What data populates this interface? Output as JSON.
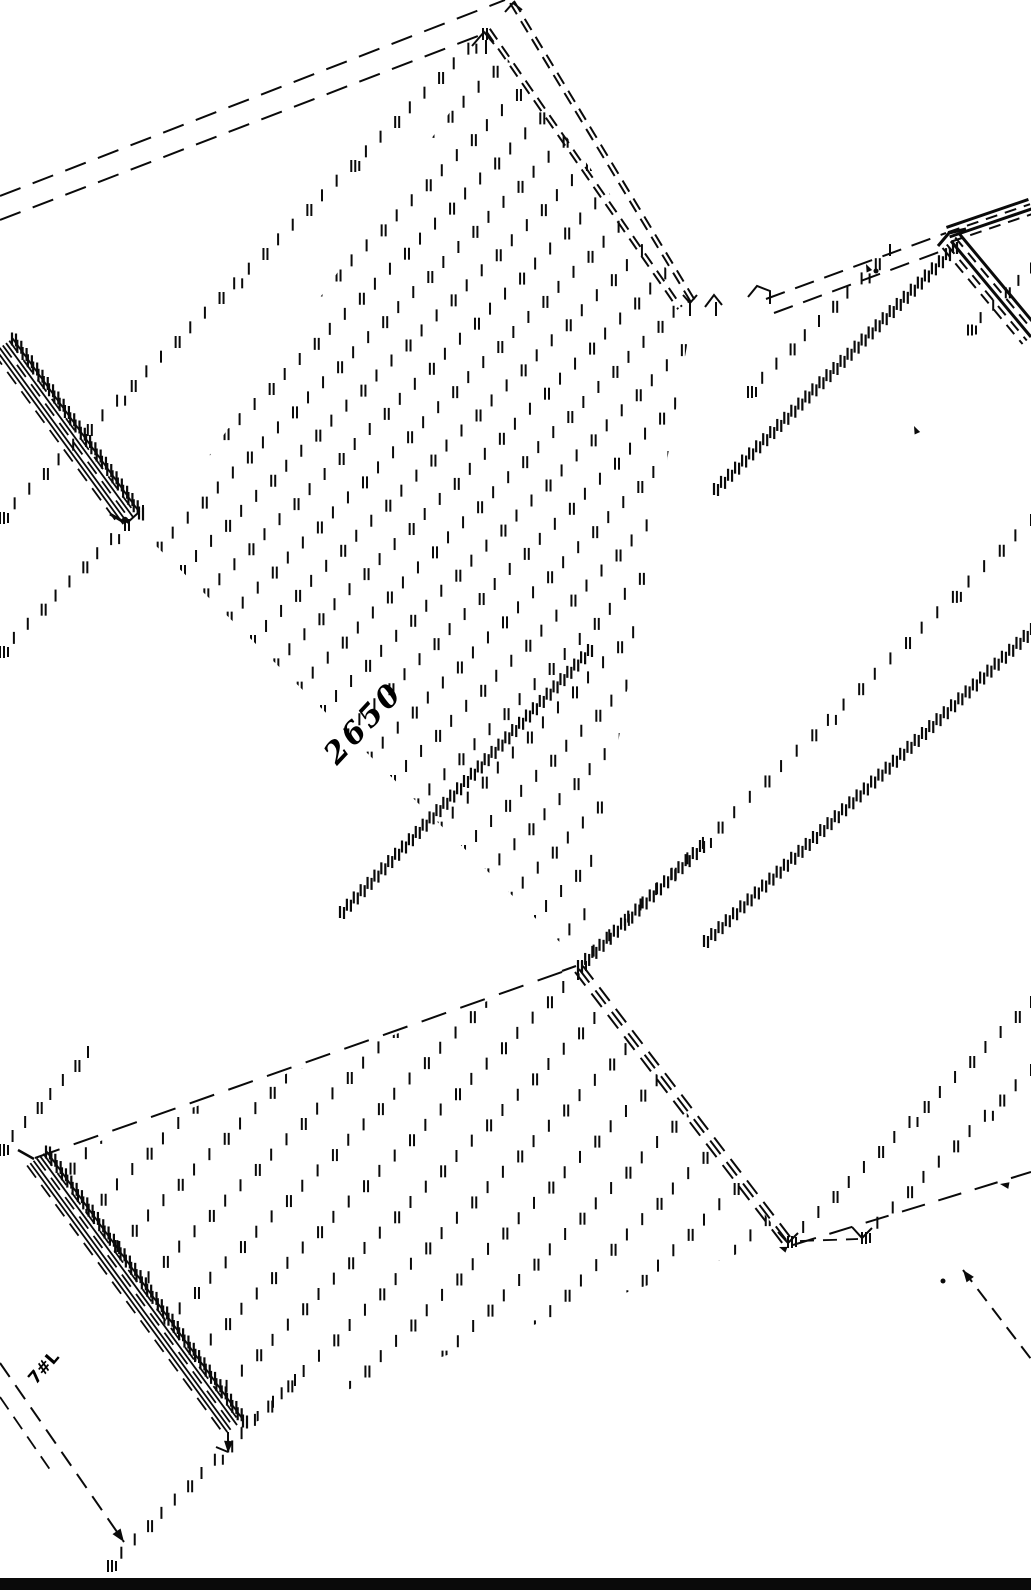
{
  "colors": {
    "ink": "#0a0a0a",
    "paper": "#ffffff"
  },
  "labels": {
    "center": {
      "text": "2650"
    },
    "bottom_left": {
      "text": "7#L"
    }
  },
  "drawing": {
    "canvas": {
      "w": 1031,
      "h": 1590
    },
    "dashed_lines": [
      {
        "id": "eave-back-1",
        "x1": 0,
        "y1": 196,
        "x2": 505,
        "y2": 0,
        "dash": [
          22,
          13
        ],
        "w": 2
      },
      {
        "id": "eave-back-2",
        "x1": 0,
        "y1": 220,
        "x2": 478,
        "y2": 36,
        "dash": [
          22,
          13
        ],
        "w": 2
      },
      {
        "id": "eave-right-1",
        "x1": 766,
        "y1": 299,
        "x2": 946,
        "y2": 233,
        "dash": [
          20,
          11
        ],
        "w": 2
      },
      {
        "id": "eave-right-2",
        "x1": 774,
        "y1": 313,
        "x2": 950,
        "y2": 248,
        "dash": [
          20,
          11
        ],
        "w": 2
      },
      {
        "id": "valley-long",
        "x1": 35,
        "y1": 1158,
        "x2": 576,
        "y2": 967,
        "dash": [
          26,
          15
        ],
        "w": 2
      },
      {
        "id": "slope-line-bl",
        "x1": 0,
        "y1": 1363,
        "x2": 124,
        "y2": 1542,
        "dash": [
          17,
          10
        ],
        "w": 2
      },
      {
        "id": "slope-line-bl-2",
        "x1": 0,
        "y1": 1397,
        "x2": 53,
        "y2": 1474,
        "dash": [
          15,
          9
        ],
        "w": 1.8
      },
      {
        "id": "bottom-right-long",
        "x1": 793,
        "y1": 1245,
        "x2": 1031,
        "y2": 1172,
        "dash": [
          24,
          14
        ],
        "w": 2
      },
      {
        "id": "bottom-right-short",
        "x1": 800,
        "y1": 1241,
        "x2": 858,
        "y2": 1239,
        "dash": [
          14,
          9
        ],
        "w": 1.8
      },
      {
        "id": "slope-line-br",
        "x1": 963,
        "y1": 1270,
        "x2": 1031,
        "y2": 1359,
        "dash": [
          15,
          9
        ],
        "w": 2
      },
      {
        "id": "ridge-band-a",
        "x1": 512,
        "y1": 2,
        "x2": 694,
        "y2": 303,
        "dash": [
          13,
          8
        ],
        "w": 2,
        "dbl": true
      },
      {
        "id": "ridge-band-b",
        "x1": 488,
        "y1": 30,
        "x2": 680,
        "y2": 308,
        "dash": [
          13,
          8
        ],
        "w": 2,
        "dbl": true
      }
    ],
    "ribbons": [
      {
        "id": "parapet-left",
        "x1": 2,
        "y1": 346,
        "x2": 129,
        "y2": 520,
        "offsets": [
          -13,
          -9,
          -5,
          -1,
          3,
          7,
          11
        ],
        "styles": [
          "s",
          "d",
          "s",
          "d",
          "s",
          "s",
          "d"
        ],
        "w": 1.8,
        "dash": [
          15,
          9
        ]
      },
      {
        "id": "parapet-lower",
        "x1": 36,
        "y1": 1159,
        "x2": 233,
        "y2": 1428,
        "offsets": [
          -13,
          -9,
          -5,
          -1,
          3,
          7,
          11
        ],
        "styles": [
          "s",
          "d",
          "s",
          "d",
          "s",
          "s",
          "d"
        ],
        "w": 1.8,
        "dash": [
          15,
          9
        ]
      },
      {
        "id": "ridge-center",
        "x1": 579,
        "y1": 969,
        "x2": 787,
        "y2": 1241,
        "offsets": [
          -5,
          0,
          5
        ],
        "styles": [
          "d",
          "d",
          "d"
        ],
        "w": 2,
        "dash": [
          17,
          10
        ]
      },
      {
        "id": "eave-tr-up",
        "x1": 949,
        "y1": 235,
        "x2": 1031,
        "y2": 207,
        "offsets": [
          -8,
          -3,
          2,
          7
        ],
        "styles": [
          "S",
          "d",
          "S",
          "d"
        ],
        "w": 2,
        "dash": [
          12,
          8
        ]
      },
      {
        "id": "eave-tr-down",
        "x1": 951,
        "y1": 241,
        "x2": 1031,
        "y2": 337,
        "offsets": [
          -11,
          -5.5,
          0,
          5.5,
          11
        ],
        "styles": [
          "S",
          "d",
          "S",
          "d",
          "d"
        ],
        "w": 2,
        "dash": [
          12,
          8
        ]
      }
    ],
    "tick_lines": [
      {
        "id": "hatch-left-long",
        "x1": 0,
        "y1": 518,
        "x2": 483,
        "y2": 34,
        "gap": 21,
        "len": 12,
        "dense": false
      },
      {
        "id": "hatch-below-corner",
        "x1": 0,
        "y1": 652,
        "x2": 125,
        "y2": 525,
        "gap": 20,
        "len": 12,
        "dense": false
      },
      {
        "id": "hatch-left-low",
        "x1": 0,
        "y1": 1150,
        "x2": 88,
        "y2": 1052,
        "gap": 20,
        "len": 12,
        "dense": false
      },
      {
        "id": "edge-ticks-parapet",
        "x1": 12,
        "y1": 339,
        "x2": 139,
        "y2": 513,
        "gap": 9,
        "len": 13,
        "dense": true
      },
      {
        "id": "edge-ticks-parapet2",
        "x1": 46,
        "y1": 1152,
        "x2": 243,
        "y2": 1421,
        "gap": 9,
        "len": 13,
        "dense": true
      },
      {
        "id": "hatch-bl-bottom",
        "x1": 108,
        "y1": 1566,
        "x2": 295,
        "y2": 1380,
        "gap": 19,
        "len": 12,
        "dense": false
      },
      {
        "id": "hatch-center-right",
        "x1": 578,
        "y1": 966,
        "x2": 1031,
        "y2": 520,
        "gap": 22,
        "len": 12,
        "dense": false
      },
      {
        "id": "hatch-cr-dense",
        "x1": 578,
        "y1": 966,
        "x2": 700,
        "y2": 846,
        "gap": 10,
        "len": 12,
        "dense": true
      },
      {
        "id": "zip-right-1",
        "x1": 714,
        "y1": 489,
        "x2": 953,
        "y2": 247,
        "gap": 10,
        "len": 12,
        "dense": true
      },
      {
        "id": "zip-right-2",
        "x1": 704,
        "y1": 941,
        "x2": 1031,
        "y2": 629,
        "gap": 10,
        "len": 12,
        "dense": true
      },
      {
        "id": "zip-center",
        "x1": 340,
        "y1": 912,
        "x2": 588,
        "y2": 650,
        "gap": 10,
        "len": 12,
        "dense": true
      },
      {
        "id": "hatch-right-upper",
        "x1": 748,
        "y1": 392,
        "x2": 890,
        "y2": 250,
        "gap": 21,
        "len": 12,
        "dense": false
      },
      {
        "id": "hatch-tr-small",
        "x1": 968,
        "y1": 330,
        "x2": 1031,
        "y2": 268,
        "gap": 18,
        "len": 11,
        "dense": false
      },
      {
        "id": "hatch-br-1",
        "x1": 788,
        "y1": 1242,
        "x2": 1031,
        "y2": 1002,
        "gap": 21,
        "len": 12,
        "dense": false
      },
      {
        "id": "hatch-br-2",
        "x1": 862,
        "y1": 1238,
        "x2": 1031,
        "y2": 1070,
        "gap": 21,
        "len": 12,
        "dense": false
      }
    ],
    "hatch_fields": [
      {
        "id": "roof-face-main",
        "poly": [
          [
            150,
            540
          ],
          [
            497,
            45
          ],
          [
            694,
            305
          ],
          [
            580,
            962
          ]
        ],
        "spacing": 33,
        "gap": 21,
        "len": 12
      },
      {
        "id": "roof-face-lower",
        "poly": [
          [
            48,
            1160
          ],
          [
            576,
            969
          ],
          [
            783,
            1238
          ],
          [
            238,
            1428
          ]
        ],
        "spacing": 44,
        "gap": 22,
        "len": 12
      }
    ],
    "corner_marks": [
      {
        "pts": [
          [
            472,
            46
          ],
          [
            484,
            32
          ],
          [
            494,
            44
          ]
        ],
        "w": 2
      },
      {
        "pts": [
          [
            486,
            40
          ],
          [
            486,
            54
          ]
        ],
        "w": 2
      },
      {
        "pts": [
          [
            505,
            12
          ],
          [
            513,
            3
          ],
          [
            522,
            10
          ]
        ],
        "w": 2
      },
      {
        "pts": [
          [
            683,
            295
          ],
          [
            690,
            303
          ],
          [
            697,
            295
          ]
        ],
        "w": 2
      },
      {
        "pts": [
          [
            690,
            303
          ],
          [
            690,
            316
          ]
        ],
        "w": 2
      },
      {
        "pts": [
          [
            705,
            307
          ],
          [
            714,
            295
          ],
          [
            722,
            305
          ]
        ],
        "w": 2
      },
      {
        "pts": [
          [
            716,
            302
          ],
          [
            716,
            316
          ]
        ],
        "w": 2
      },
      {
        "pts": [
          [
            748,
            297
          ],
          [
            757,
            286
          ],
          [
            770,
            291
          ],
          [
            770,
            304
          ]
        ],
        "w": 2
      },
      {
        "pts": [
          [
            938,
            246
          ],
          [
            949,
            233
          ],
          [
            966,
            229
          ]
        ],
        "w": 3
      },
      {
        "pts": [
          [
            562,
            971
          ],
          [
            576,
            966
          ]
        ],
        "w": 2
      },
      {
        "pts": [
          [
            578,
            962
          ],
          [
            578,
            980
          ]
        ],
        "w": 2
      },
      {
        "pts": [
          [
            778,
            1232
          ],
          [
            788,
            1243
          ],
          [
            798,
            1233
          ]
        ],
        "w": 2
      },
      {
        "pts": [
          [
            852,
            1227
          ],
          [
            862,
            1238
          ],
          [
            872,
            1228
          ]
        ],
        "w": 2
      },
      {
        "pts": [
          [
            18,
            1150
          ],
          [
            34,
            1159
          ]
        ],
        "w": 2.5
      },
      {
        "pts": [
          [
            110,
            514
          ],
          [
            122,
            521
          ]
        ],
        "w": 3
      },
      {
        "pts": [
          [
            127,
            523
          ],
          [
            138,
            513
          ]
        ],
        "w": 2
      },
      {
        "pts": [
          [
            143,
            505
          ],
          [
            143,
            518
          ]
        ],
        "w": 2
      },
      {
        "pts": [
          [
            228,
            1432
          ],
          [
            228,
            1450
          ]
        ],
        "w": 2
      },
      {
        "pts": [
          [
            216,
            1447
          ],
          [
            228,
            1452
          ]
        ],
        "w": 2
      }
    ],
    "arrows": [
      {
        "x": 124,
        "y": 1542,
        "a": 55,
        "s": 13
      },
      {
        "x": 228,
        "y": 1453,
        "a": 93,
        "s": 12
      },
      {
        "x": 963,
        "y": 1270,
        "a": 233,
        "s": 12
      },
      {
        "x": 1000,
        "y": 1184,
        "a": 190,
        "s": 9
      },
      {
        "x": 866,
        "y": 264,
        "a": 245,
        "s": 8
      },
      {
        "x": 914,
        "y": 426,
        "a": 245,
        "s": 8
      },
      {
        "x": 779,
        "y": 1247,
        "a": 200,
        "s": 8
      }
    ],
    "dots": [
      {
        "x": 943,
        "y": 1281,
        "r": 2.5
      },
      {
        "x": 876,
        "y": 271,
        "r": 2.5
      },
      {
        "x": 125,
        "y": 520,
        "r": 3.2
      }
    ],
    "bars": [
      {
        "x": 0,
        "y": 1578,
        "w": 1031,
        "h": 12
      }
    ]
  }
}
